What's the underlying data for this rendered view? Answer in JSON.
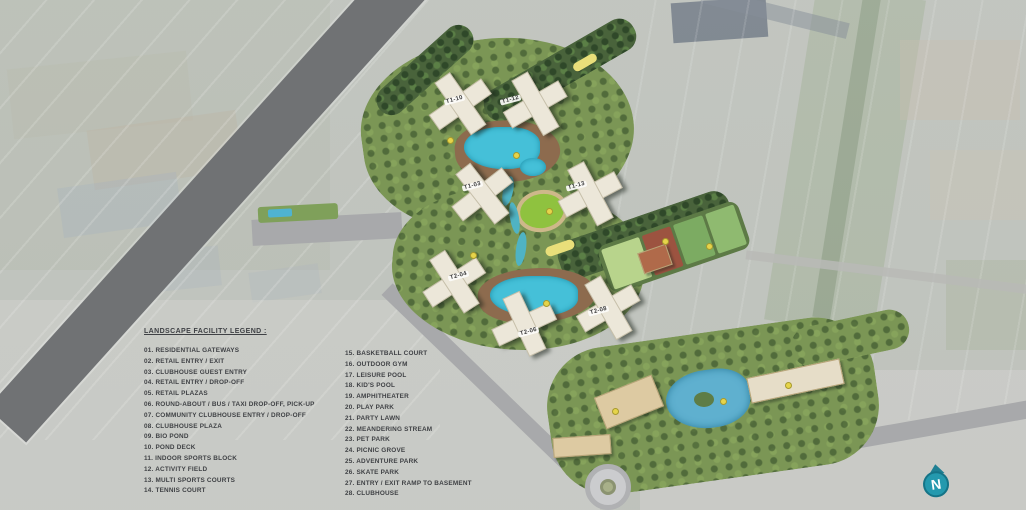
{
  "page": {
    "type": "residential-masterplan-aerial-siteplan"
  },
  "legend": {
    "title": "LANDSCAPE FACILITY LEGEND :",
    "items_left": [
      "01. RESIDENTIAL GATEWAYS",
      "02. RETAIL ENTRY / EXIT",
      "03. CLUBHOUSE GUEST ENTRY",
      "04. RETAIL ENTRY / DROP-OFF",
      "05. RETAIL PLAZAS",
      "06. ROUND-ABOUT / BUS / TAXI DROP-OFF, PICK-UP",
      "07. COMMUNITY CLUBHOUSE ENTRY / DROP-OFF",
      "08. CLUBHOUSE PLAZA",
      "09. BIO POND",
      "10. POND DECK",
      "11. INDOOR SPORTS BLOCK",
      "12. ACTIVITY FIELD",
      "13. MULTI SPORTS COURTS",
      "14. TENNIS COURT"
    ],
    "items_right": [
      "15. BASKETBALL COURT",
      "16. OUTDOOR GYM",
      "17. LEISURE POOL",
      "18. KID'S POOL",
      "19. AMPHITHEATER",
      "20. PLAY PARK",
      "21. PARTY LAWN",
      "22. MEANDERING STREAM",
      "23. PET PARK",
      "24. PICNIC GROVE",
      "25. ADVENTURE PARK",
      "26. SKATE PARK",
      "27. ENTRY / EXIT RAMP TO BASEMENT",
      "28. CLUBHOUSE"
    ]
  },
  "towers": [
    {
      "label": "T1-10"
    },
    {
      "label": "T1-12"
    },
    {
      "label": "T1-03"
    },
    {
      "label": "T1-13"
    },
    {
      "label": "T2-04"
    },
    {
      "label": "T2-06"
    },
    {
      "label": "T2-08"
    }
  ],
  "compass": {
    "label": "N"
  },
  "colors": {
    "highway": "#707274",
    "plan_green": "#7b9655",
    "tree_dark": "#49633b",
    "pool_cyan": "#45c0d8",
    "bio_pond_blue": "#5fb0cf",
    "building_cream": "#ece7d9",
    "clubhouse_tan": "#ddcaa2",
    "court_red": "#9c5340",
    "court_green": "#7cab62",
    "field_green": "#b8d48c",
    "marker_yellow": "#e6d44a",
    "compass_teal": "#2499ae",
    "legend_text": "#3f4145"
  }
}
